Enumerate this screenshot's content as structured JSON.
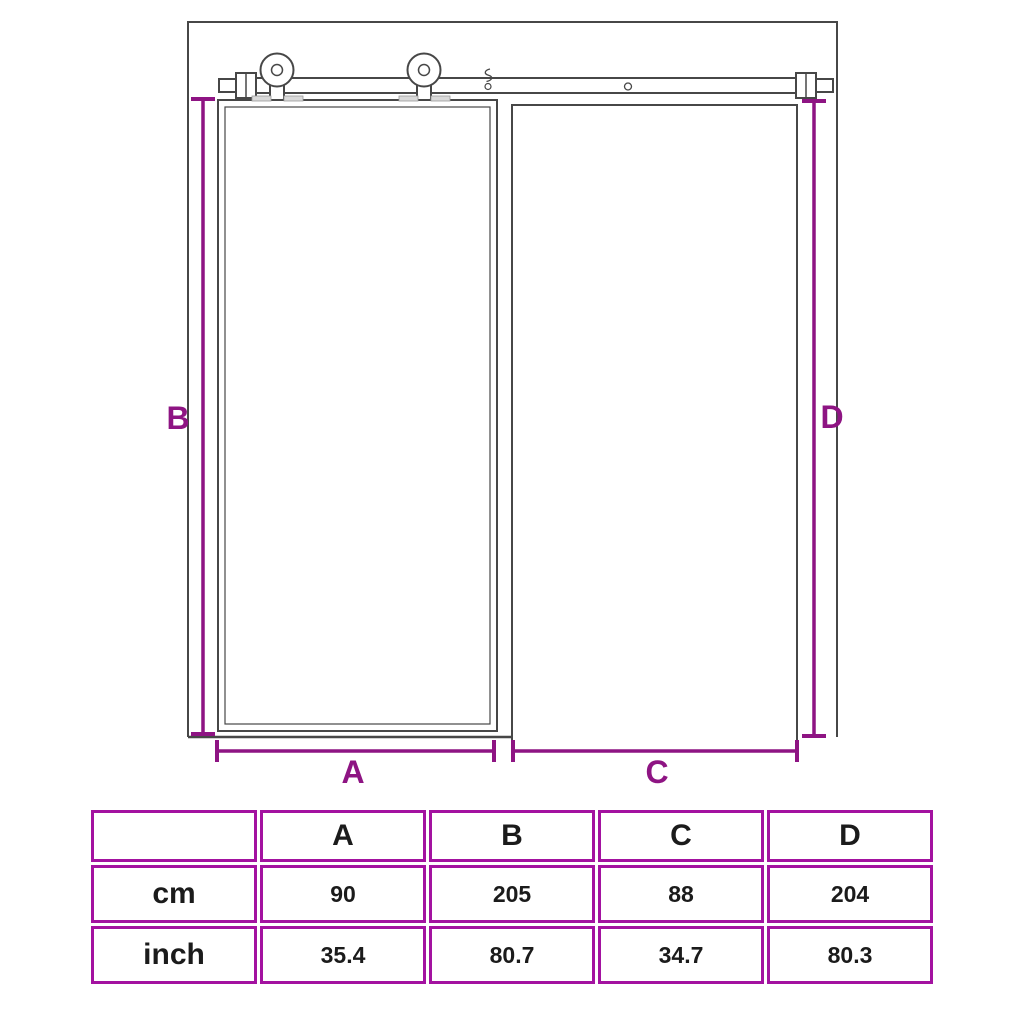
{
  "colors": {
    "accent": "#8E1483",
    "table_border": "#A312A0",
    "drawing": "#474747"
  },
  "diagram": {
    "description": "sliding-barn-door-with-rail-and-doorway-opening",
    "labels": {
      "A": "A",
      "B": "B",
      "C": "C",
      "D": "D"
    }
  },
  "table": {
    "columns": [
      "A",
      "B",
      "C",
      "D"
    ],
    "rows": [
      {
        "unit": "cm",
        "values": [
          "90",
          "205",
          "88",
          "204"
        ]
      },
      {
        "unit": "inch",
        "values": [
          "35.4",
          "80.7",
          "34.7",
          "80.3"
        ]
      }
    ]
  }
}
